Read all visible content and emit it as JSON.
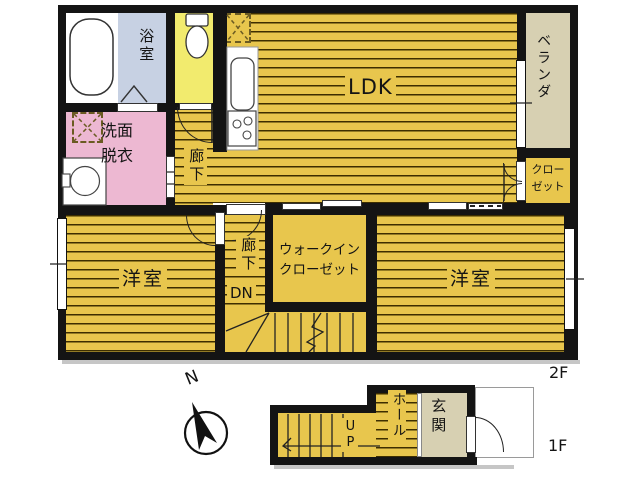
{
  "plan2f": {
    "floor_label": "2F",
    "ldk": "LDK",
    "bath": "浴室",
    "washroom": "洗面\n脱衣",
    "corridor_upper": "廊下",
    "corridor_lower": "廊下",
    "down": "DN",
    "veranda": "ベランダ",
    "closet": "クロー\nゼット",
    "walk_in_closet": "ウォークイン\nクローゼット",
    "bedroom_left": "洋室",
    "bedroom_right": "洋室"
  },
  "plan1f": {
    "floor_label": "1F",
    "hall": "ホール",
    "entrance": "玄関",
    "up": "UP"
  },
  "compass": {
    "north": "N"
  },
  "colors": {
    "wall": "#141414",
    "floor_yellow": "#e8c64d",
    "stripe": "#3d2e00",
    "toilet_room_yellow": "#f2eb6e",
    "bathroom_blue": "#c7d1e3",
    "washroom_pink": "#edb8d2",
    "veranda_beige": "#d7d0b2",
    "shadow_gray": "#c6c6c6"
  },
  "fixtures": [
    "bathtub",
    "toilet",
    "kitchen-sink",
    "stove",
    "washbasin",
    "refrigerator-space",
    "washing-machine-space",
    "stairs",
    "entrance-door",
    "compass"
  ]
}
